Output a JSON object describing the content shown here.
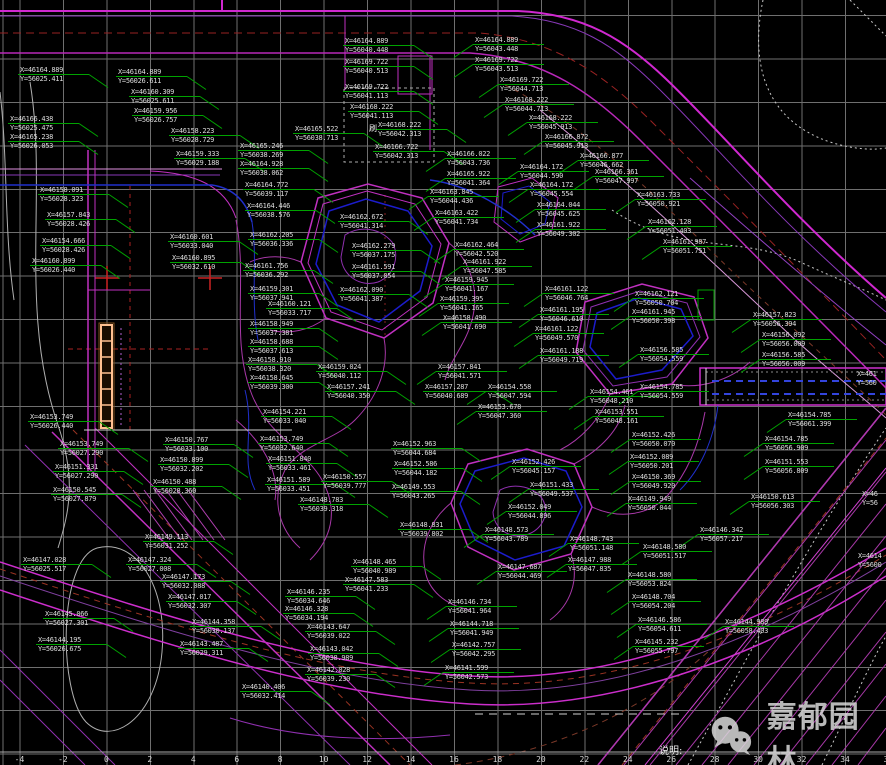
{
  "drawing": {
    "notes_text": "说明:",
    "watermark": {
      "text": "嘉郁园林"
    },
    "colors": {
      "background": "#000000",
      "grid": "#6f6f6f",
      "label_text": "#dcdcdc",
      "leader_green": "#00a300",
      "magenta": "#cc2ecc",
      "purple": "#8838b8",
      "pond_blue": "#1c1ccc",
      "red_dash": "#992222",
      "brown_dash": "#7a3828",
      "white_contour": "#c8c8c8",
      "orange_detail": "#ffc090"
    },
    "ruler": {
      "y": 755,
      "start_x": 19.5,
      "spacing": 43.45,
      "values": [
        -4,
        -2,
        0,
        2,
        4,
        6,
        8,
        10,
        12,
        14,
        16,
        18,
        20,
        22,
        24,
        26,
        28,
        30,
        32,
        34,
        36
      ]
    },
    "stray_texts": [
      {
        "x": 369,
        "y": 123,
        "text": "刷"
      }
    ],
    "coordinate_labels": [
      {
        "x": 20,
        "y": 66,
        "l1": "X=46164.889",
        "l2": "Y=56025.411"
      },
      {
        "x": 118,
        "y": 68,
        "l1": "X=46164.889",
        "l2": "Y=56026.611"
      },
      {
        "x": 131,
        "y": 88,
        "l1": "X=46160.309",
        "l2": "Y=56025.611"
      },
      {
        "x": 134,
        "y": 107,
        "l1": "X=46159.956",
        "l2": "Y=56026.757"
      },
      {
        "x": 10,
        "y": 115,
        "l1": "X=46166.438",
        "l2": "Y=56025.475"
      },
      {
        "x": 171,
        "y": 127,
        "l1": "X=46158.223",
        "l2": "Y=56028.729"
      },
      {
        "x": 10,
        "y": 133,
        "l1": "X=46165.238",
        "l2": "Y=56026.053"
      },
      {
        "x": 176,
        "y": 150,
        "l1": "X=46159.333",
        "l2": "Y=56029.188"
      },
      {
        "x": 40,
        "y": 186,
        "l1": "X=46158.091",
        "l2": "Y=56028.323"
      },
      {
        "x": 47,
        "y": 211,
        "l1": "X=46157.843",
        "l2": "Y=56028.426"
      },
      {
        "x": 42,
        "y": 237,
        "l1": "X=46154.666",
        "l2": "Y=56028.426"
      },
      {
        "x": 32,
        "y": 257,
        "l1": "X=46160.899",
        "l2": "Y=56026.440"
      },
      {
        "x": 170,
        "y": 233,
        "l1": "X=46160.601",
        "l2": "Y=56033.040"
      },
      {
        "x": 172,
        "y": 254,
        "l1": "X=46160.895",
        "l2": "Y=56032.610"
      },
      {
        "x": 345,
        "y": 37,
        "l1": "X=46164.889",
        "l2": "Y=56040.448"
      },
      {
        "x": 345,
        "y": 58,
        "l1": "X=46169.722",
        "l2": "Y=56040.513"
      },
      {
        "x": 345,
        "y": 83,
        "l1": "X=46169.722",
        "l2": "Y=56041.113"
      },
      {
        "x": 350,
        "y": 103,
        "l1": "X=46168.222",
        "l2": "Y=56041.113"
      },
      {
        "x": 295,
        "y": 125,
        "l1": "X=46165.522",
        "l2": "Y=56038.713"
      },
      {
        "x": 378,
        "y": 121,
        "l1": "X=46168.222",
        "l2": "Y=56042.313"
      },
      {
        "x": 240,
        "y": 142,
        "l1": "X=46165.246",
        "l2": "Y=56038.269"
      },
      {
        "x": 375,
        "y": 143,
        "l1": "X=46166.722",
        "l2": "Y=56042.313"
      },
      {
        "x": 240,
        "y": 160,
        "l1": "X=46164.928",
        "l2": "Y=56038.062"
      },
      {
        "x": 245,
        "y": 181,
        "l1": "X=46164.772",
        "l2": "Y=56039.117"
      },
      {
        "x": 247,
        "y": 202,
        "l1": "X=46164.446",
        "l2": "Y=56038.576"
      },
      {
        "x": 475,
        "y": 36,
        "l1": "X=46164.889",
        "l2": "Y=56043.448"
      },
      {
        "x": 475,
        "y": 56,
        "l1": "X=46169.722",
        "l2": "Y=56043.513"
      },
      {
        "x": 500,
        "y": 76,
        "l1": "X=46169.722",
        "l2": "Y=56044.713"
      },
      {
        "x": 505,
        "y": 96,
        "l1": "X=46168.222",
        "l2": "Y=56044.713"
      },
      {
        "x": 529,
        "y": 114,
        "l1": "X=46168.222",
        "l2": "Y=56045.913"
      },
      {
        "x": 545,
        "y": 133,
        "l1": "X=46166.872",
        "l2": "Y=56045.913"
      },
      {
        "x": 580,
        "y": 152,
        "l1": "X=46166.877",
        "l2": "Y=56046.662"
      },
      {
        "x": 520,
        "y": 163,
        "l1": "X=46164.172",
        "l2": "Y=56044.590"
      },
      {
        "x": 595,
        "y": 168,
        "l1": "X=46166.361",
        "l2": "Y=56047.997"
      },
      {
        "x": 530,
        "y": 181,
        "l1": "X=46164.172",
        "l2": "Y=56045.554"
      },
      {
        "x": 637,
        "y": 191,
        "l1": "X=46163.733",
        "l2": "Y=56050.921"
      },
      {
        "x": 430,
        "y": 188,
        "l1": "X=46163.845",
        "l2": "Y=56044.436"
      },
      {
        "x": 435,
        "y": 209,
        "l1": "X=46163.422",
        "l2": "Y=56041.734"
      },
      {
        "x": 340,
        "y": 213,
        "l1": "X=46162.672",
        "l2": "Y=56041.314"
      },
      {
        "x": 250,
        "y": 231,
        "l1": "X=46162.205",
        "l2": "Y=56036.336"
      },
      {
        "x": 352,
        "y": 242,
        "l1": "X=46162.279",
        "l2": "Y=56037.175"
      },
      {
        "x": 352,
        "y": 263,
        "l1": "X=46161.591",
        "l2": "Y=56037.054"
      },
      {
        "x": 245,
        "y": 262,
        "l1": "X=46161.756",
        "l2": "Y=56036.292"
      },
      {
        "x": 250,
        "y": 285,
        "l1": "X=46159.301",
        "l2": "Y=56037.941"
      },
      {
        "x": 340,
        "y": 286,
        "l1": "X=46162.090",
        "l2": "Y=56041.387"
      },
      {
        "x": 268,
        "y": 300,
        "l1": "X=46160.121",
        "l2": "Y=56033.717"
      },
      {
        "x": 250,
        "y": 320,
        "l1": "X=46158.949",
        "l2": "Y=56037.381"
      },
      {
        "x": 250,
        "y": 338,
        "l1": "X=46158.688",
        "l2": "Y=56037.613"
      },
      {
        "x": 248,
        "y": 356,
        "l1": "X=46158.910",
        "l2": "Y=56038.320"
      },
      {
        "x": 318,
        "y": 363,
        "l1": "X=46159.024",
        "l2": "Y=56040.112"
      },
      {
        "x": 250,
        "y": 374,
        "l1": "X=46158.645",
        "l2": "Y=56039.300"
      },
      {
        "x": 327,
        "y": 383,
        "l1": "X=46157.241",
        "l2": "Y=56040.350"
      },
      {
        "x": 425,
        "y": 383,
        "l1": "X=46157.287",
        "l2": "Y=56040.689"
      },
      {
        "x": 438,
        "y": 363,
        "l1": "X=46157.841",
        "l2": "Y=56041.571"
      },
      {
        "x": 455,
        "y": 241,
        "l1": "X=46162.464",
        "l2": "Y=56042.520"
      },
      {
        "x": 463,
        "y": 258,
        "l1": "X=46161.922",
        "l2": "Y=56047.585"
      },
      {
        "x": 445,
        "y": 276,
        "l1": "X=46159.945",
        "l2": "Y=56041.167"
      },
      {
        "x": 440,
        "y": 295,
        "l1": "X=46159.395",
        "l2": "Y=56041.165"
      },
      {
        "x": 443,
        "y": 314,
        "l1": "X=46158.490",
        "l2": "Y=56041.690"
      },
      {
        "x": 537,
        "y": 201,
        "l1": "X=46164.044",
        "l2": "Y=56045.625"
      },
      {
        "x": 537,
        "y": 221,
        "l1": "X=46161.922",
        "l2": "Y=56049.302"
      },
      {
        "x": 648,
        "y": 218,
        "l1": "X=46162.128",
        "l2": "Y=56051.403"
      },
      {
        "x": 663,
        "y": 238,
        "l1": "X=46161.987",
        "l2": "Y=56051.751"
      },
      {
        "x": 545,
        "y": 285,
        "l1": "X=46161.122",
        "l2": "Y=56046.764"
      },
      {
        "x": 635,
        "y": 290,
        "l1": "X=46162.121",
        "l2": "Y=56050.704"
      },
      {
        "x": 632,
        "y": 308,
        "l1": "X=46161.945",
        "l2": "Y=56050.398"
      },
      {
        "x": 540,
        "y": 306,
        "l1": "X=46161.195",
        "l2": "Y=56046.610"
      },
      {
        "x": 535,
        "y": 325,
        "l1": "X=46161.122",
        "l2": "Y=56049.570"
      },
      {
        "x": 540,
        "y": 347,
        "l1": "X=46161.188",
        "l2": "Y=56049.719"
      },
      {
        "x": 640,
        "y": 346,
        "l1": "X=46156.585",
        "l2": "Y=56054.559"
      },
      {
        "x": 753,
        "y": 311,
        "l1": "X=46157.823",
        "l2": "Y=56056.394"
      },
      {
        "x": 762,
        "y": 331,
        "l1": "X=46156.092",
        "l2": "Y=56056.009"
      },
      {
        "x": 762,
        "y": 351,
        "l1": "X=46156.585",
        "l2": "Y=56056.009"
      },
      {
        "x": 447,
        "y": 150,
        "l1": "X=46166.022",
        "l2": "Y=56043.736"
      },
      {
        "x": 447,
        "y": 170,
        "l1": "X=46165.922",
        "l2": "Y=56041.364"
      },
      {
        "x": 700,
        "y": 526,
        "l1": "X=46146.342",
        "l2": "Y=56057.217"
      },
      {
        "x": 788,
        "y": 411,
        "l1": "X=46154.785",
        "l2": "Y=56061.399"
      },
      {
        "x": 765,
        "y": 435,
        "l1": "X=46154.785",
        "l2": "Y=56056.909"
      },
      {
        "x": 765,
        "y": 458,
        "l1": "X=46151.553",
        "l2": "Y=56056.809"
      },
      {
        "x": 751,
        "y": 493,
        "l1": "X=46150.613",
        "l2": "Y=56056.303"
      },
      {
        "x": 640,
        "y": 383,
        "l1": "X=46154.785",
        "l2": "Y=56054.559"
      },
      {
        "x": 30,
        "y": 413,
        "l1": "X=46153.749",
        "l2": "Y=56026.440"
      },
      {
        "x": 60,
        "y": 440,
        "l1": "X=46153.749",
        "l2": "Y=56027.290"
      },
      {
        "x": 165,
        "y": 436,
        "l1": "X=46150.767",
        "l2": "Y=56033.100"
      },
      {
        "x": 160,
        "y": 456,
        "l1": "X=46150.899",
        "l2": "Y=56032.202"
      },
      {
        "x": 55,
        "y": 463,
        "l1": "X=46151.331",
        "l2": "Y=56027.290"
      },
      {
        "x": 153,
        "y": 478,
        "l1": "X=46150.488",
        "l2": "Y=56028.360"
      },
      {
        "x": 53,
        "y": 486,
        "l1": "X=46150.545",
        "l2": "Y=56027.879"
      },
      {
        "x": 145,
        "y": 533,
        "l1": "X=46149.113",
        "l2": "Y=56031.252"
      },
      {
        "x": 23,
        "y": 556,
        "l1": "X=46147.028",
        "l2": "Y=56025.517"
      },
      {
        "x": 128,
        "y": 556,
        "l1": "X=46147.324",
        "l2": "Y=56027.008"
      },
      {
        "x": 162,
        "y": 573,
        "l1": "X=46147.173",
        "l2": "Y=56032.088"
      },
      {
        "x": 168,
        "y": 593,
        "l1": "X=46147.017",
        "l2": "Y=56032.307"
      },
      {
        "x": 45,
        "y": 610,
        "l1": "X=46145.066",
        "l2": "Y=56027.301"
      },
      {
        "x": 192,
        "y": 618,
        "l1": "X=46144.358",
        "l2": "Y=56030.137"
      },
      {
        "x": 38,
        "y": 636,
        "l1": "X=46144.195",
        "l2": "Y=56026.675"
      },
      {
        "x": 180,
        "y": 640,
        "l1": "X=46143.487",
        "l2": "Y=56029.311"
      },
      {
        "x": 263,
        "y": 408,
        "l1": "X=46154.221",
        "l2": "Y=56033.040"
      },
      {
        "x": 260,
        "y": 435,
        "l1": "X=46153.749",
        "l2": "Y=56032.640"
      },
      {
        "x": 268,
        "y": 455,
        "l1": "X=46151.840",
        "l2": "Y=56033.461"
      },
      {
        "x": 393,
        "y": 440,
        "l1": "X=46152.963",
        "l2": "Y=56044.684"
      },
      {
        "x": 394,
        "y": 460,
        "l1": "X=46152.586",
        "l2": "Y=56044.182"
      },
      {
        "x": 267,
        "y": 476,
        "l1": "X=46151.589",
        "l2": "Y=56033.451"
      },
      {
        "x": 323,
        "y": 473,
        "l1": "X=46150.557",
        "l2": "Y=56039.777"
      },
      {
        "x": 392,
        "y": 483,
        "l1": "X=46149.553",
        "l2": "Y=56043.265"
      },
      {
        "x": 300,
        "y": 496,
        "l1": "X=46148.783",
        "l2": "Y=56039.318"
      },
      {
        "x": 400,
        "y": 521,
        "l1": "X=46148.831",
        "l2": "Y=56039.802"
      },
      {
        "x": 353,
        "y": 558,
        "l1": "X=46148.465",
        "l2": "Y=56040.989"
      },
      {
        "x": 345,
        "y": 576,
        "l1": "X=46147.583",
        "l2": "Y=56041.233"
      },
      {
        "x": 287,
        "y": 588,
        "l1": "X=46146.235",
        "l2": "Y=56034.646"
      },
      {
        "x": 285,
        "y": 605,
        "l1": "X=46146.328",
        "l2": "Y=56034.194"
      },
      {
        "x": 307,
        "y": 623,
        "l1": "X=46143.647",
        "l2": "Y=56039.022"
      },
      {
        "x": 310,
        "y": 645,
        "l1": "X=46143.042",
        "l2": "Y=56038.989"
      },
      {
        "x": 307,
        "y": 666,
        "l1": "X=46142.028",
        "l2": "Y=56039.230"
      },
      {
        "x": 242,
        "y": 683,
        "l1": "X=46140.406",
        "l2": "Y=56032.414"
      },
      {
        "x": 448,
        "y": 598,
        "l1": "X=46146.734",
        "l2": "Y=56041.964"
      },
      {
        "x": 450,
        "y": 620,
        "l1": "X=46144.718",
        "l2": "Y=56041.949"
      },
      {
        "x": 452,
        "y": 641,
        "l1": "X=46142.757",
        "l2": "Y=56042.295"
      },
      {
        "x": 445,
        "y": 664,
        "l1": "X=46141.599",
        "l2": "Y=56042.573"
      },
      {
        "x": 488,
        "y": 383,
        "l1": "X=46154.558",
        "l2": "Y=56047.594"
      },
      {
        "x": 590,
        "y": 388,
        "l1": "X=46154.461",
        "l2": "Y=56048.210"
      },
      {
        "x": 478,
        "y": 403,
        "l1": "X=46153.678",
        "l2": "Y=56047.360"
      },
      {
        "x": 595,
        "y": 408,
        "l1": "X=46153.551",
        "l2": "Y=56048.161"
      },
      {
        "x": 632,
        "y": 431,
        "l1": "X=46152.426",
        "l2": "Y=56050.070"
      },
      {
        "x": 512,
        "y": 458,
        "l1": "X=46152.426",
        "l2": "Y=56045.157"
      },
      {
        "x": 630,
        "y": 453,
        "l1": "X=46152.089",
        "l2": "Y=56050.201"
      },
      {
        "x": 632,
        "y": 473,
        "l1": "X=46150.369",
        "l2": "Y=56049.920"
      },
      {
        "x": 530,
        "y": 481,
        "l1": "X=46151.433",
        "l2": "Y=56049.537"
      },
      {
        "x": 628,
        "y": 495,
        "l1": "X=46149.949",
        "l2": "Y=56050.044"
      },
      {
        "x": 508,
        "y": 503,
        "l1": "X=46152.049",
        "l2": "Y=56044.896"
      },
      {
        "x": 485,
        "y": 526,
        "l1": "X=46148.573",
        "l2": "Y=56043.789"
      },
      {
        "x": 570,
        "y": 535,
        "l1": "X=46148.743",
        "l2": "Y=56051.148"
      },
      {
        "x": 643,
        "y": 543,
        "l1": "X=46148.580",
        "l2": "Y=56051.517"
      },
      {
        "x": 568,
        "y": 556,
        "l1": "X=46147.988",
        "l2": "Y=56047.835"
      },
      {
        "x": 498,
        "y": 563,
        "l1": "X=46147.687",
        "l2": "Y=56044.469"
      },
      {
        "x": 628,
        "y": 571,
        "l1": "X=46148.580",
        "l2": "Y=56053.824"
      },
      {
        "x": 632,
        "y": 593,
        "l1": "X=46148.704",
        "l2": "Y=56054.204"
      },
      {
        "x": 638,
        "y": 616,
        "l1": "X=46146.586",
        "l2": "Y=56054.611"
      },
      {
        "x": 635,
        "y": 638,
        "l1": "X=46145.232",
        "l2": "Y=56055.797"
      },
      {
        "x": 725,
        "y": 618,
        "l1": "X=46144.989",
        "l2": "Y=56058.403"
      },
      {
        "x": 857,
        "y": 370,
        "l1": "X=461",
        "l2": "Y=560",
        "partial": true
      },
      {
        "x": 862,
        "y": 490,
        "l1": "X=46",
        "l2": "Y=56",
        "partial": true
      },
      {
        "x": 858,
        "y": 552,
        "l1": "X=4614",
        "l2": "Y=5600",
        "partial": true
      }
    ]
  }
}
